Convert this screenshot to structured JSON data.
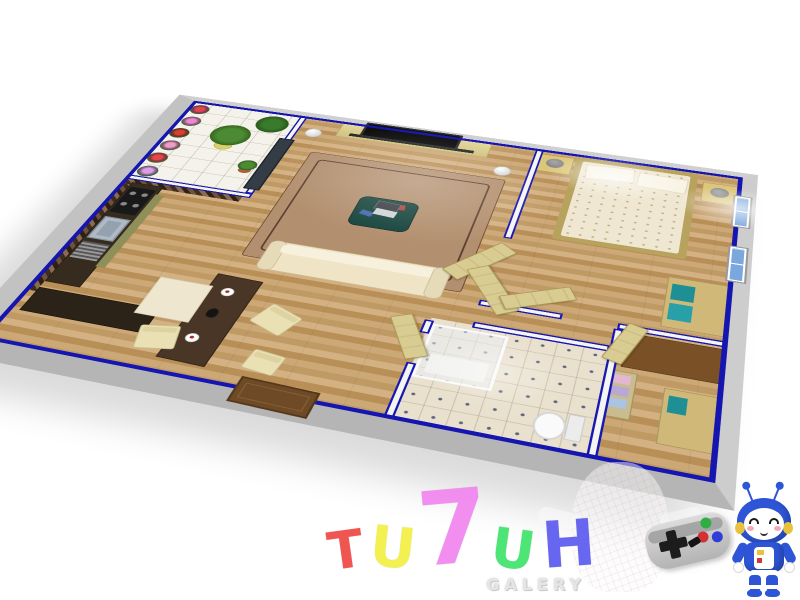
{
  "watermark": {
    "title": "TU7UH",
    "title_letters": [
      {
        "char": "T",
        "color": "#ef4a44"
      },
      {
        "char": "U",
        "color": "#f3ef45"
      },
      {
        "char": "7",
        "color": "#f086ee"
      },
      {
        "char": "U",
        "color": "#3fe46c"
      },
      {
        "char": "H",
        "color": "#5b5bf0"
      }
    ],
    "subtitle": "GALERY",
    "subtitle_color": "#e5e5e5"
  },
  "scene": {
    "description": "3D rendered top-down oblique floor plan of a one-bedroom apartment on a white background",
    "wall_trim_color": "#1515b0",
    "outer_wall_color": "#c6c6c6",
    "wood_floor_color": "#c59d6b",
    "rooms": [
      {
        "name": "balcony-garden",
        "features": [
          "hanging-flower-baskets",
          "potted-plants",
          "white-tile-floor",
          "dark-glass-door"
        ]
      },
      {
        "name": "kitchen",
        "features": [
          "l-shaped-dark-counter",
          "gas-stove-4-burners",
          "steel-sink",
          "drainboard",
          "cream-fridge",
          "brown-mosaic-backsplash"
        ]
      },
      {
        "name": "living-room",
        "features": [
          "flat-screen-tv",
          "tan-tv-console",
          "brown-area-rug",
          "cream-sofa",
          "teal-coffee-table",
          "laptop",
          "magazines",
          "floor-lamps"
        ]
      },
      {
        "name": "dining-area",
        "features": [
          "dark-bar-table",
          "coffee-cups",
          "cream-chairs",
          "front-door-brown"
        ]
      },
      {
        "name": "bedroom",
        "features": [
          "double-bed-polka-dot",
          "two-pillows",
          "nightstands",
          "gray-table-lamps",
          "tan-dresser-teal-drawers",
          "blue-windows",
          "ceiling-lights"
        ]
      },
      {
        "name": "bathroom",
        "features": [
          "glass-shower-enclosure",
          "white-toilet",
          "dotted-beige-tile-floor",
          "light-wood-door"
        ]
      },
      {
        "name": "storage-room",
        "features": [
          "brown-vanity-desk",
          "towel-shelf",
          "tan-cabinet"
        ]
      }
    ]
  },
  "badges": {
    "gamepad": {
      "body_color": "#c4c4c4",
      "dpad_color": "#1c1c1c",
      "button_colors": [
        "#2fae44",
        "#d03131",
        "#2f3fd6"
      ]
    },
    "robot": {
      "body_color": "#2d55d6",
      "face_color": "#ffffff",
      "ear_color": "#e8c23c",
      "cheek_color": "#f5a8b8"
    },
    "ghost_color": "rgba(250,250,252,0.62)"
  }
}
